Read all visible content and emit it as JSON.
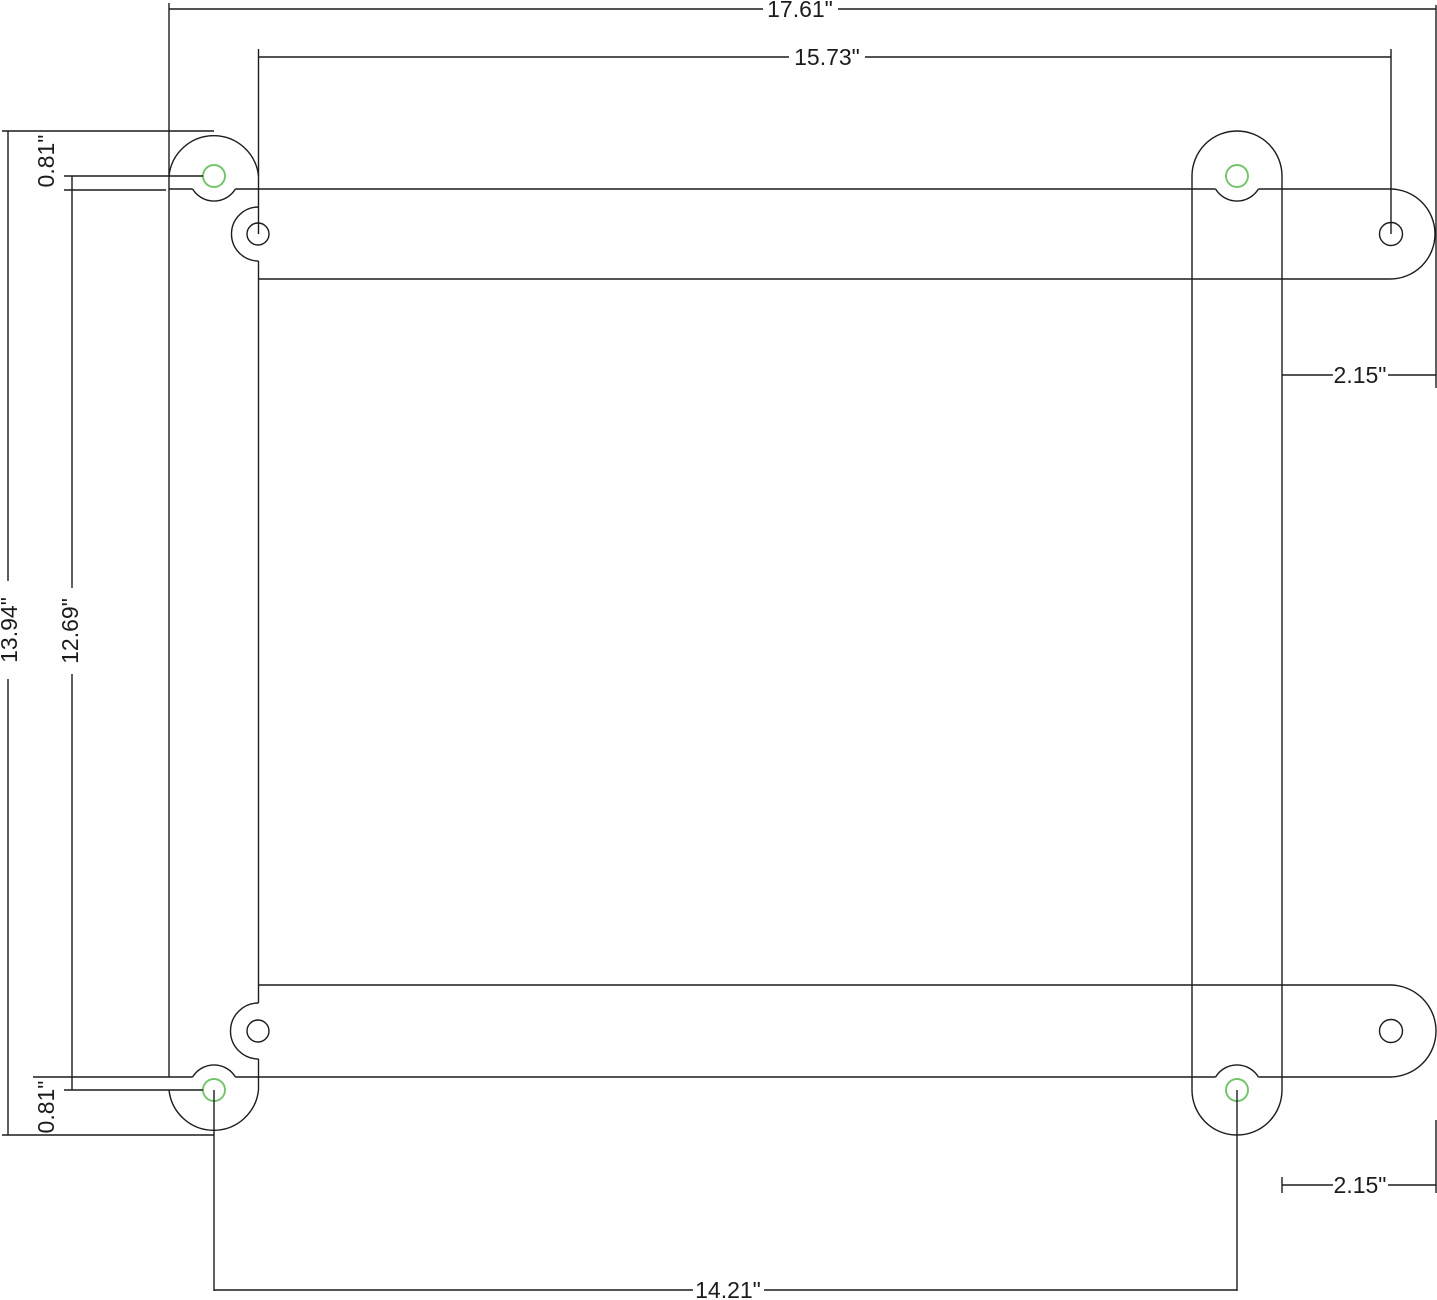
{
  "drawing": {
    "title": "mounting-frame-dimensioned-drawing",
    "units": "inches",
    "colors": {
      "background": "#ffffff",
      "line": "#1c1c1c",
      "pilot_hole_highlight": "#72c46a"
    },
    "dimensions": {
      "overall_width": "17.61\"",
      "upper_hole_span": "15.73\"",
      "overall_height": "13.94\"",
      "left_hole_span": "12.69\"",
      "top_ear_protrusion": "0.81\"",
      "bottom_ear_protrusion": "0.81\"",
      "right_tab_length_top": "2.15\"",
      "right_tab_length_bottom": "2.15\"",
      "lower_hole_span": "14.21\""
    }
  }
}
